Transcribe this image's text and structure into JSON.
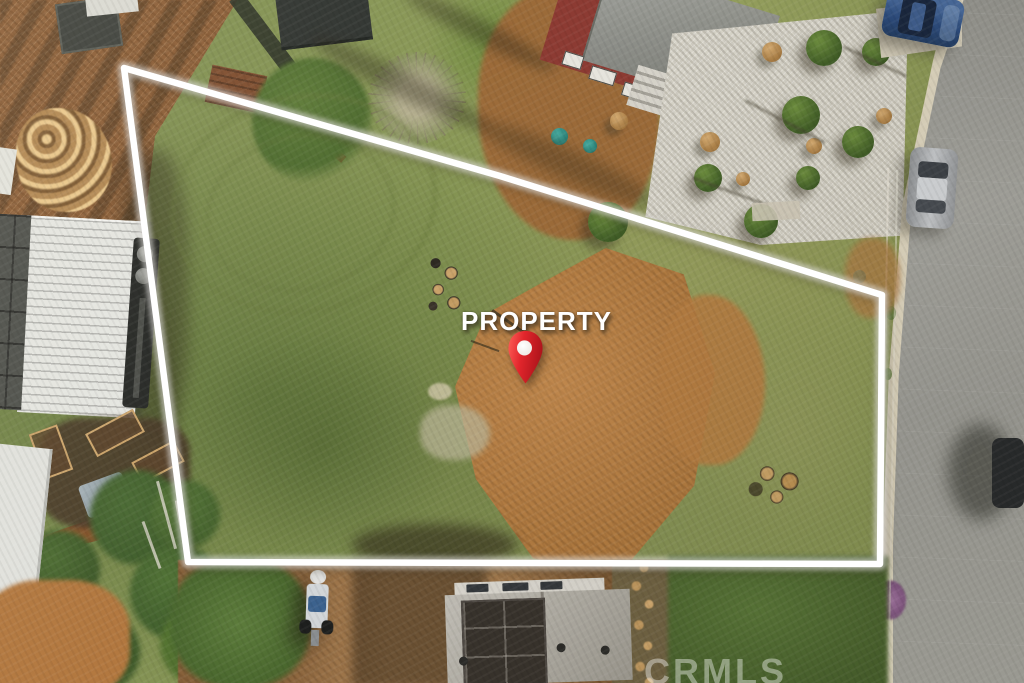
{
  "photo": {
    "description": "aerial-view-vacant-land-listing",
    "overlay": {
      "property_label": "PROPERTY",
      "pin_icon": "red-map-pin",
      "boundary_color": "#ffffff",
      "pin_color": "#d81f26",
      "label_color": "#ffffff"
    },
    "watermark": {
      "text": "CRMLS"
    }
  }
}
